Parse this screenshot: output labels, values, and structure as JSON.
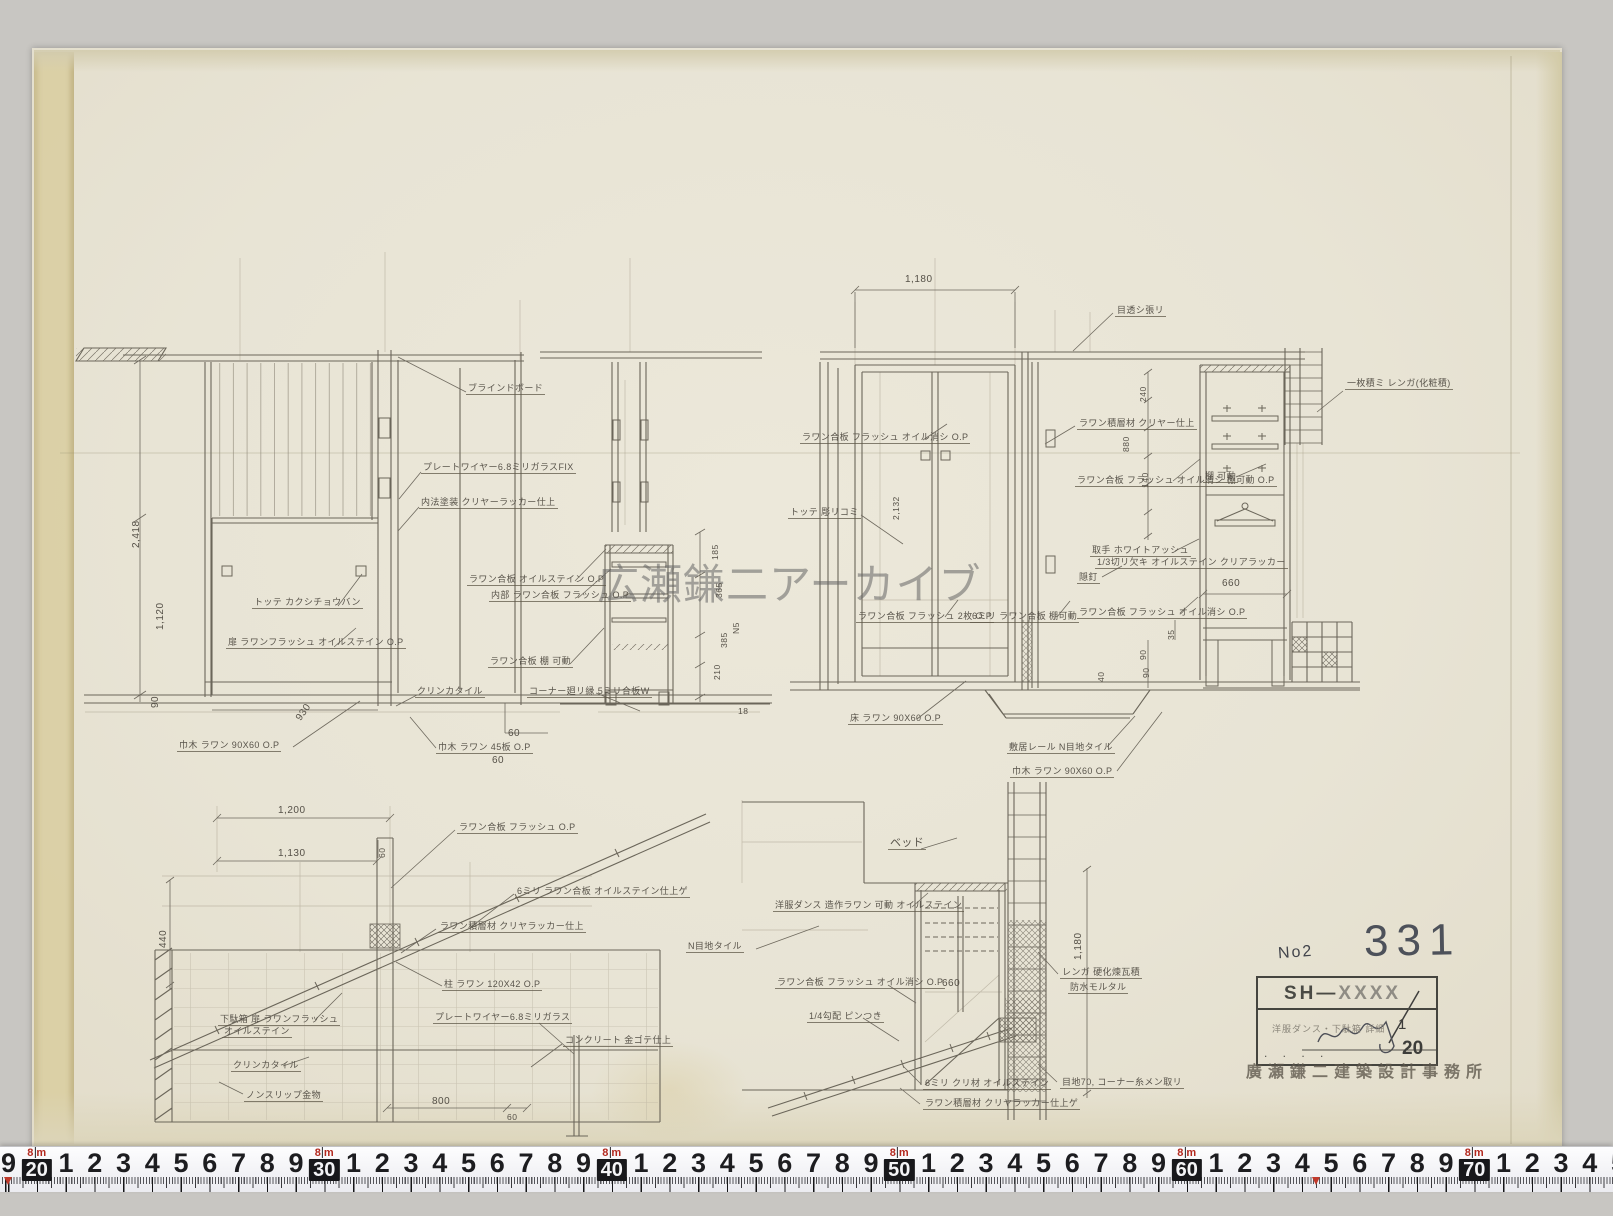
{
  "watermark": {
    "text": "広瀬鎌二アーカイブ"
  },
  "title_block": {
    "no_label": "No2",
    "sheet_number": "331",
    "project_code_prefix": "SH—",
    "project_code_suffix": "XXXX",
    "drawing_title": "洋服ダンス・下駄箱 詳細",
    "scale_numerator": "1",
    "scale_denominator": "20",
    "dots_row": ". . . .",
    "office_stamp": "廣瀬鎌二建築設計事務所"
  },
  "ruler": {
    "meter_top": "8",
    "meter_unit": "m",
    "cells": [
      [
        "9",
        0
      ],
      [
        "20",
        1
      ],
      [
        "1",
        0
      ],
      [
        "2",
        0
      ],
      [
        "3",
        0
      ],
      [
        "4",
        0
      ],
      [
        "5",
        0
      ],
      [
        "6",
        0
      ],
      [
        "7",
        0
      ],
      [
        "8",
        0
      ],
      [
        "9",
        0
      ],
      [
        "30",
        1
      ],
      [
        "1",
        0
      ],
      [
        "2",
        0
      ],
      [
        "3",
        0
      ],
      [
        "4",
        0
      ],
      [
        "5",
        0
      ],
      [
        "6",
        0
      ],
      [
        "7",
        0
      ],
      [
        "8",
        0
      ],
      [
        "9",
        0
      ],
      [
        "40",
        1
      ],
      [
        "1",
        0
      ],
      [
        "2",
        0
      ],
      [
        "3",
        0
      ],
      [
        "4",
        0
      ],
      [
        "5",
        0
      ],
      [
        "6",
        0
      ],
      [
        "7",
        0
      ],
      [
        "8",
        0
      ],
      [
        "9",
        0
      ],
      [
        "50",
        1
      ],
      [
        "1",
        0
      ],
      [
        "2",
        0
      ],
      [
        "3",
        0
      ],
      [
        "4",
        0
      ],
      [
        "5",
        0
      ],
      [
        "6",
        0
      ],
      [
        "7",
        0
      ],
      [
        "8",
        0
      ],
      [
        "9",
        0
      ],
      [
        "60",
        1
      ],
      [
        "1",
        0
      ],
      [
        "2",
        0
      ],
      [
        "3",
        0
      ],
      [
        "4",
        0
      ],
      [
        "5",
        0
      ],
      [
        "6",
        0
      ],
      [
        "7",
        0
      ],
      [
        "8",
        0
      ],
      [
        "9",
        0
      ],
      [
        "70",
        1
      ],
      [
        "1",
        0
      ],
      [
        "2",
        0
      ],
      [
        "3",
        0
      ],
      [
        "4",
        0
      ],
      [
        "5",
        0
      ]
    ],
    "red_marker_cms": [
      19,
      64.5
    ]
  },
  "ann": {
    "a": [
      "ブラインドボード",
      "プレートワイヤー6.8ミリガラスFIX",
      "内法塗装 クリヤーラッカー仕上",
      "トッテ カクシチョウバン",
      "扉 ラワンフラッシュ オイルステイン O.P",
      "巾木 ラワン 90X60 O.P",
      "クリンカタイル",
      "巾木 ラワン 45板 O.P"
    ],
    "b": [
      "ラワン合板 オイルステイン O.P",
      "内部 ラワン合板 フラッシュ O.P",
      "ラワン合板 棚 可動",
      "コーナー廻リ縁 5ミリ合板W"
    ],
    "c": [
      "目透シ張リ",
      "ラワン合板 フラッシュ オイル消シ O.P",
      "トッテ 彫リコミ",
      "床 ラワン 90X60 O.P",
      "敷居レール N目地タイル",
      "巾木 ラワン 90X60 O.P",
      "ラワン合板 フラッシュ 2枚 O.P",
      "6ミリ ラワン合板 棚可動"
    ],
    "d": [
      "一枚積ミ レンガ(化粧積)",
      "ラワン積層材 クリヤー仕上",
      "ラワン合板 フラッシュ オイル消シ 棚可動 O.P",
      "棚 可動",
      "取手 ホワイトアッシュ",
      "1/3切リ欠キ オイルステイン クリアラッカー",
      "隠釘",
      "ラワン合板 フラッシュ オイル消シ O.P"
    ],
    "e": [
      "ラワン合板 フラッシュ O.P",
      "6ミリ ラワン合板 オイルステイン仕上ゲ",
      "ラワン積層材 クリヤラッカー仕上",
      "柱 ラワン 120X42 O.P",
      "下駄箱 扉 ラワンフラッシュ",
      "オイルステイン",
      "クリンカタイル",
      "ノンスリップ金物",
      "プレートワイヤー6.8ミリガラス",
      "コンクリート 金ゴテ仕上"
    ],
    "f": [
      "ベッド",
      "洋服ダンス 造作ラワン 可動 オイルステイン",
      "N目地タイル",
      "ラワン合板 フラッシュ オイル消シ O.P",
      "1/4勾配 ピンつき",
      "レンガ 硬化煉瓦積",
      "防水モルタル",
      "6ミリ クリ材 オイルステイン",
      "ラワン積層材 クリヤラッカー仕上ゲ",
      "目地70, コーナー糸メン取リ"
    ]
  },
  "dim": {
    "a": [
      "2,418",
      "1,120",
      "90",
      "930",
      "60",
      "60"
    ],
    "b": [
      "185",
      "365",
      "385",
      "210",
      "N5",
      "18"
    ],
    "c": [
      "1,180",
      "2,132"
    ],
    "d": [
      "240",
      "880",
      "140",
      "660",
      "35",
      "90",
      "90",
      "40"
    ],
    "e": [
      "1,200",
      "1,130",
      "60",
      "440",
      "800",
      "60"
    ],
    "f": [
      "1,180",
      "660"
    ]
  }
}
